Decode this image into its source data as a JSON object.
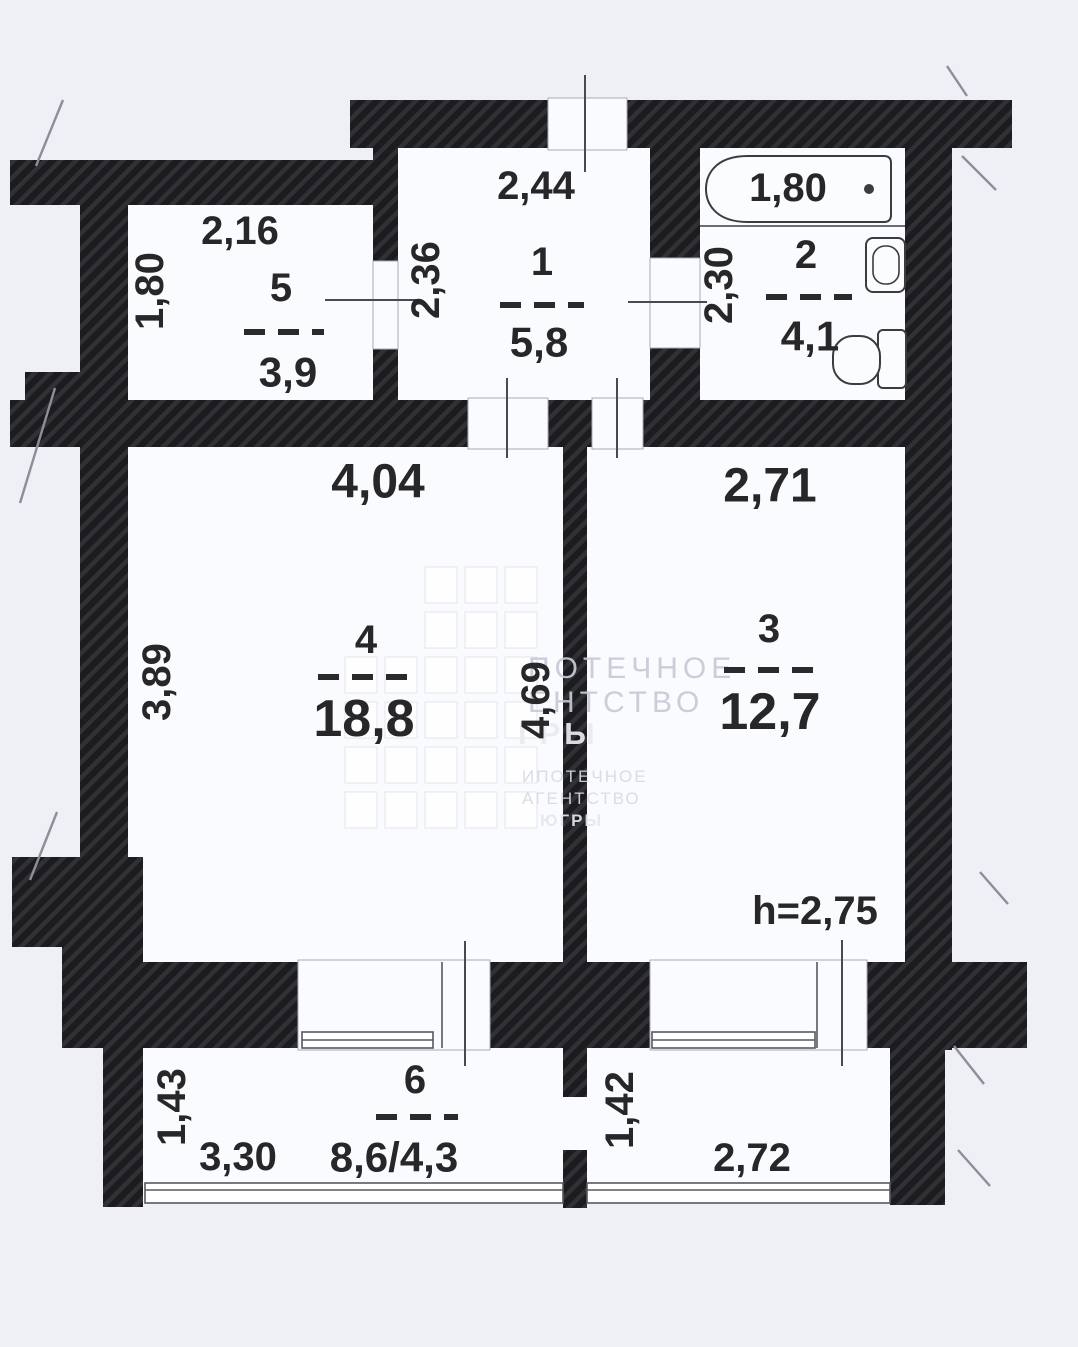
{
  "plan_title": "Apartment floor plan",
  "rooms": {
    "r1": {
      "number": "1",
      "area": "5,8",
      "width": "2,44",
      "depth": "2,36"
    },
    "r2": {
      "number": "2",
      "area": "4,1",
      "tub_length": "1,80",
      "depth": "2,30"
    },
    "r3": {
      "number": "3",
      "area": "12,7",
      "width": "2,71",
      "ceiling_height": "h=2,75"
    },
    "r4": {
      "number": "4",
      "area": "18,8",
      "width": "4,04",
      "depth": "3,89",
      "inner_depth": "4,69"
    },
    "r5": {
      "number": "5",
      "area": "3,9",
      "width": "2,16",
      "depth": "1,80"
    },
    "b6": {
      "number": "6",
      "area": "8,6/4,3",
      "width": "3,30",
      "depth": "1,43"
    },
    "b7": {
      "width": "2,72",
      "depth": "1,42"
    }
  },
  "watermark": {
    "big": [
      "ПОТЕЧНОЕ",
      "ЕНТСТВО",
      "ГРЫ"
    ],
    "small": [
      "ИПОТЕЧНОЕ",
      "АГЕНТСТВО",
      "ЮГРЫ"
    ],
    "grid": [
      "00111",
      "00111",
      "11111",
      "11111",
      "11111",
      "11111"
    ]
  },
  "colors": {
    "wall": "#1c1c1f",
    "wall_hatch": "#303036",
    "floor": "#fafbfe",
    "background": "#eef0f6",
    "ink": "#27272a"
  }
}
